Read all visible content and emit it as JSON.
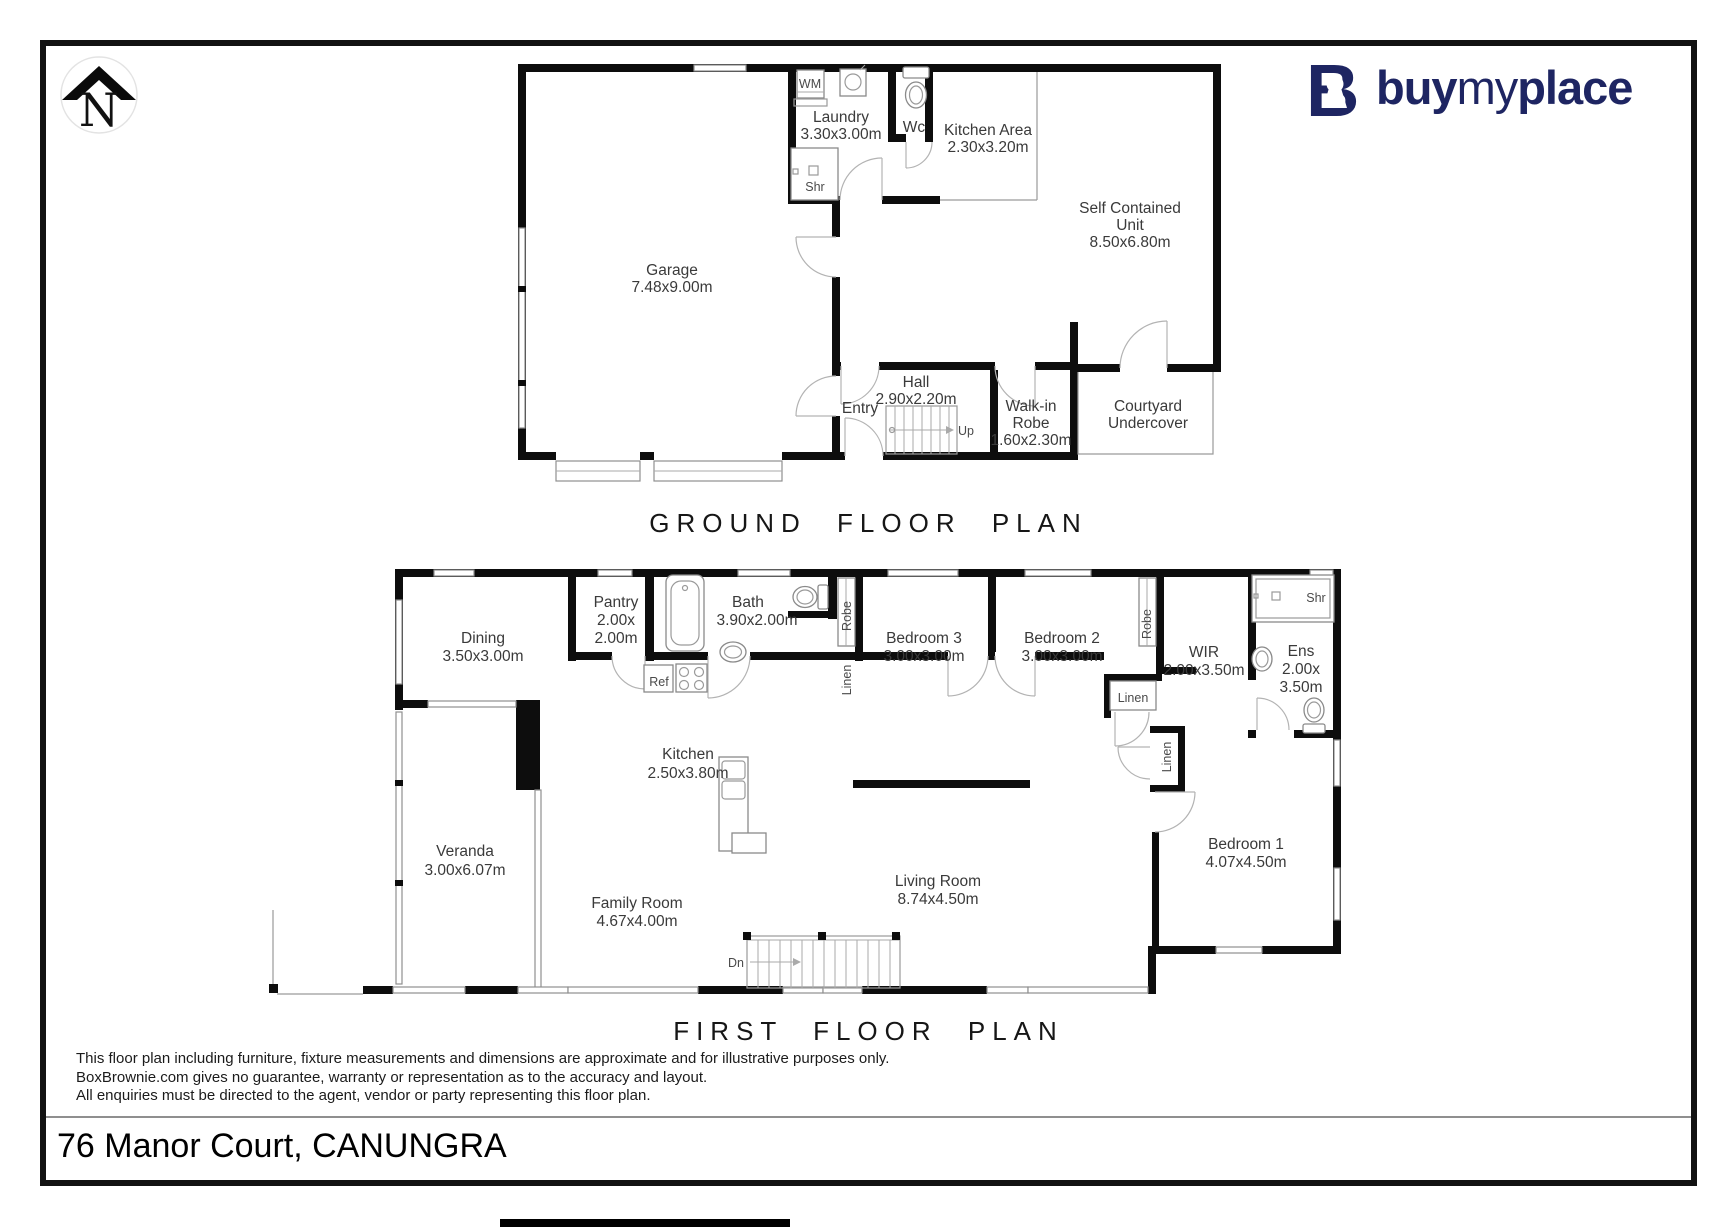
{
  "compass": {
    "north": "N"
  },
  "logo": {
    "part1": "buy",
    "part2": "my",
    "part3": "place",
    "brand_color": "#1e2562"
  },
  "ground": {
    "heading": "GROUND FLOOR PLAN",
    "garage": {
      "name": "Garage",
      "dims": "7.48x9.00m"
    },
    "laundry": {
      "name": "Laundry",
      "dims": "3.30x3.00m"
    },
    "wc": {
      "name": "Wc"
    },
    "kitchen_area": {
      "name": "Kitchen Area",
      "dims": "2.30x3.20m"
    },
    "scu": {
      "name1": "Self Contained",
      "name2": "Unit",
      "dims": "8.50x6.80m"
    },
    "hall": {
      "name": "Hall",
      "dims": "2.90x2.20m"
    },
    "entry": {
      "name": "Entry"
    },
    "walkin": {
      "name1": "Walk-in",
      "name2": "Robe",
      "dims": "1.60x2.30m"
    },
    "courtyard": {
      "name1": "Courtyard",
      "name2": "Undercover"
    },
    "wm": "WM",
    "shr": "Shr",
    "up": "Up"
  },
  "first": {
    "heading": "FIRST FLOOR PLAN",
    "dining": {
      "name": "Dining",
      "dims": "3.50x3.00m"
    },
    "pantry": {
      "name": "Pantry",
      "dims1": "2.00x",
      "dims2": "2.00m"
    },
    "bath": {
      "name": "Bath",
      "dims": "3.90x2.00m"
    },
    "bedroom3": {
      "name": "Bedroom 3",
      "dims": "3.00x3.00m"
    },
    "bedroom2": {
      "name": "Bedroom 2",
      "dims": "3.00x3.00m"
    },
    "wir": {
      "name": "WIR",
      "dims": "2.00x3.50m"
    },
    "ens": {
      "name": "Ens",
      "dims1": "2.00x",
      "dims2": "3.50m"
    },
    "veranda": {
      "name": "Veranda",
      "dims": "3.00x6.07m"
    },
    "kitchen": {
      "name": "Kitchen",
      "dims": "2.50x3.80m"
    },
    "family": {
      "name": "Family Room",
      "dims": "4.67x4.00m"
    },
    "living": {
      "name": "Living Room",
      "dims": "8.74x4.50m"
    },
    "bedroom1": {
      "name": "Bedroom 1",
      "dims": "4.07x4.50m"
    },
    "robe": "Robe",
    "linen": "Linen",
    "ref": "Ref",
    "shr": "Shr",
    "dn": "Dn"
  },
  "disclaimer": {
    "line1": "This floor plan including furniture, fixture measurements and dimensions are approximate and for illustrative purposes only.",
    "line2": "BoxBrownie.com gives no guarantee, warranty or representation as to the accuracy and layout.",
    "line3": "All enquiries must be directed to the agent, vendor or party representing this floor plan."
  },
  "footer": {
    "address": "76 Manor Court, CANUNGRA"
  }
}
